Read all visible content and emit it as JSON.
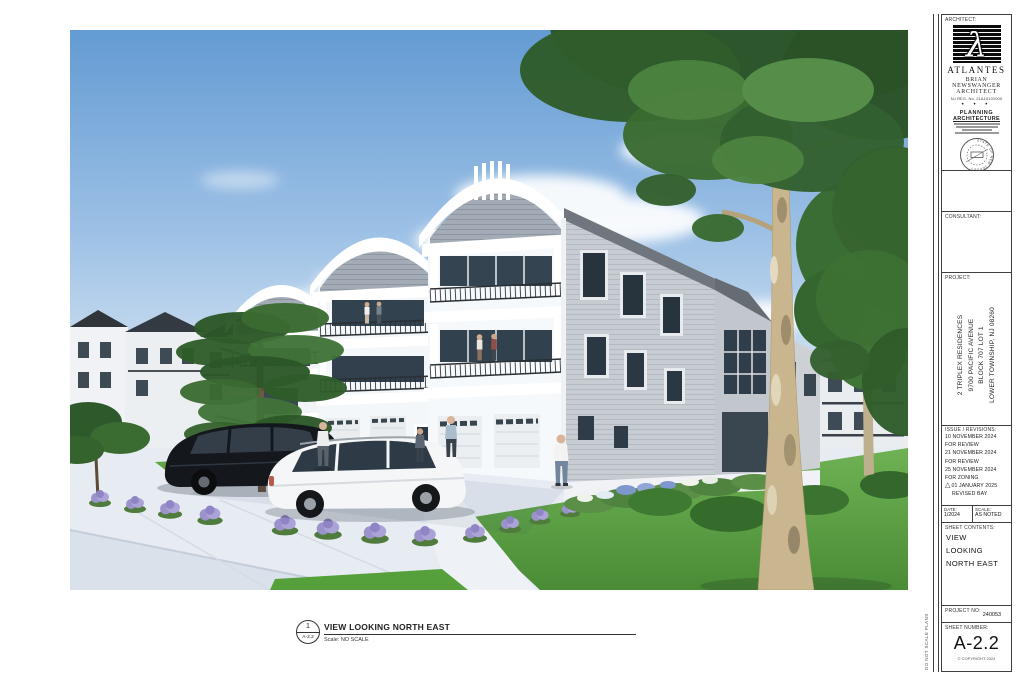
{
  "sheet": {
    "view_label": {
      "detail_number": "1",
      "detail_sheet": "A-2.2",
      "title": "VIEW LOOKING NORTH EAST",
      "scale_text": "Scale: NO SCALE"
    },
    "side_note": "DO NOT SCALE PLANS"
  },
  "title_block": {
    "architect": {
      "label": "ARCHITECT:",
      "logo_glyph": "λ",
      "firm": "ATLANTES",
      "name": "BRIAN NEWSWANGER",
      "title": "ARCHITECT",
      "registration": "NJ REG. No. 21A10101000",
      "separator": "• • •",
      "practice_line1": "PLANNING",
      "practice_line2": "ARCHITECTURE",
      "seal_text": "STATE OF NEW JERSEY"
    },
    "consultant": {
      "label": "CONSULTANT:"
    },
    "project": {
      "label": "PROJECT:",
      "lines": [
        "2 TRIPLEX RESIDENCES",
        "9700 PACIFIC AVENUE",
        "BLOCK 707 LOT 1",
        "LOWER TOWNSHIP, NJ 08260"
      ]
    },
    "revisions": {
      "label": "ISSUE / REVISIONS:",
      "delta_glyph": "△",
      "lines": [
        "10 NOVEMBER 2024",
        "FOR REVIEW",
        "21 NOVEMBER 2024",
        "FOR REVIEW",
        "25 NOVEMBER 2024",
        "FOR ZONING",
        "01 JANUARY 2025",
        "REVISED BAY"
      ]
    },
    "date": {
      "label": "DATE:",
      "value": "1/2024"
    },
    "scale": {
      "label": "SCALE:",
      "value": "AS NOTED"
    },
    "sheet_contents": {
      "label": "SHEET CONTENTS:",
      "lines": [
        "VIEW",
        "LOOKING",
        "NORTH EAST"
      ]
    },
    "project_no": {
      "label": "PROJECT NO:",
      "value": "240053"
    },
    "sheet_number": {
      "label": "SHEET NUMBER:",
      "value": "A-2.2",
      "copyright": "© COPYRIGHT 2024"
    }
  },
  "palette": {
    "sky_blue": "#639BD3",
    "cloud_white": "#FFFFFF",
    "wall_white": "#F5F7F9",
    "siding_gray": "#C7CCD2",
    "shingle_gray": "#A3ACB6",
    "railing_dark": "#2A2F34",
    "glass_dark": "#33424F",
    "lawn_green": "#57A03C",
    "foliage_green": "#336031",
    "trunk_tan": "#C9B68E",
    "lavender": "#9C93CC",
    "pavement": "#E7ECF3",
    "titleblock_line": "#3F3F3F"
  }
}
